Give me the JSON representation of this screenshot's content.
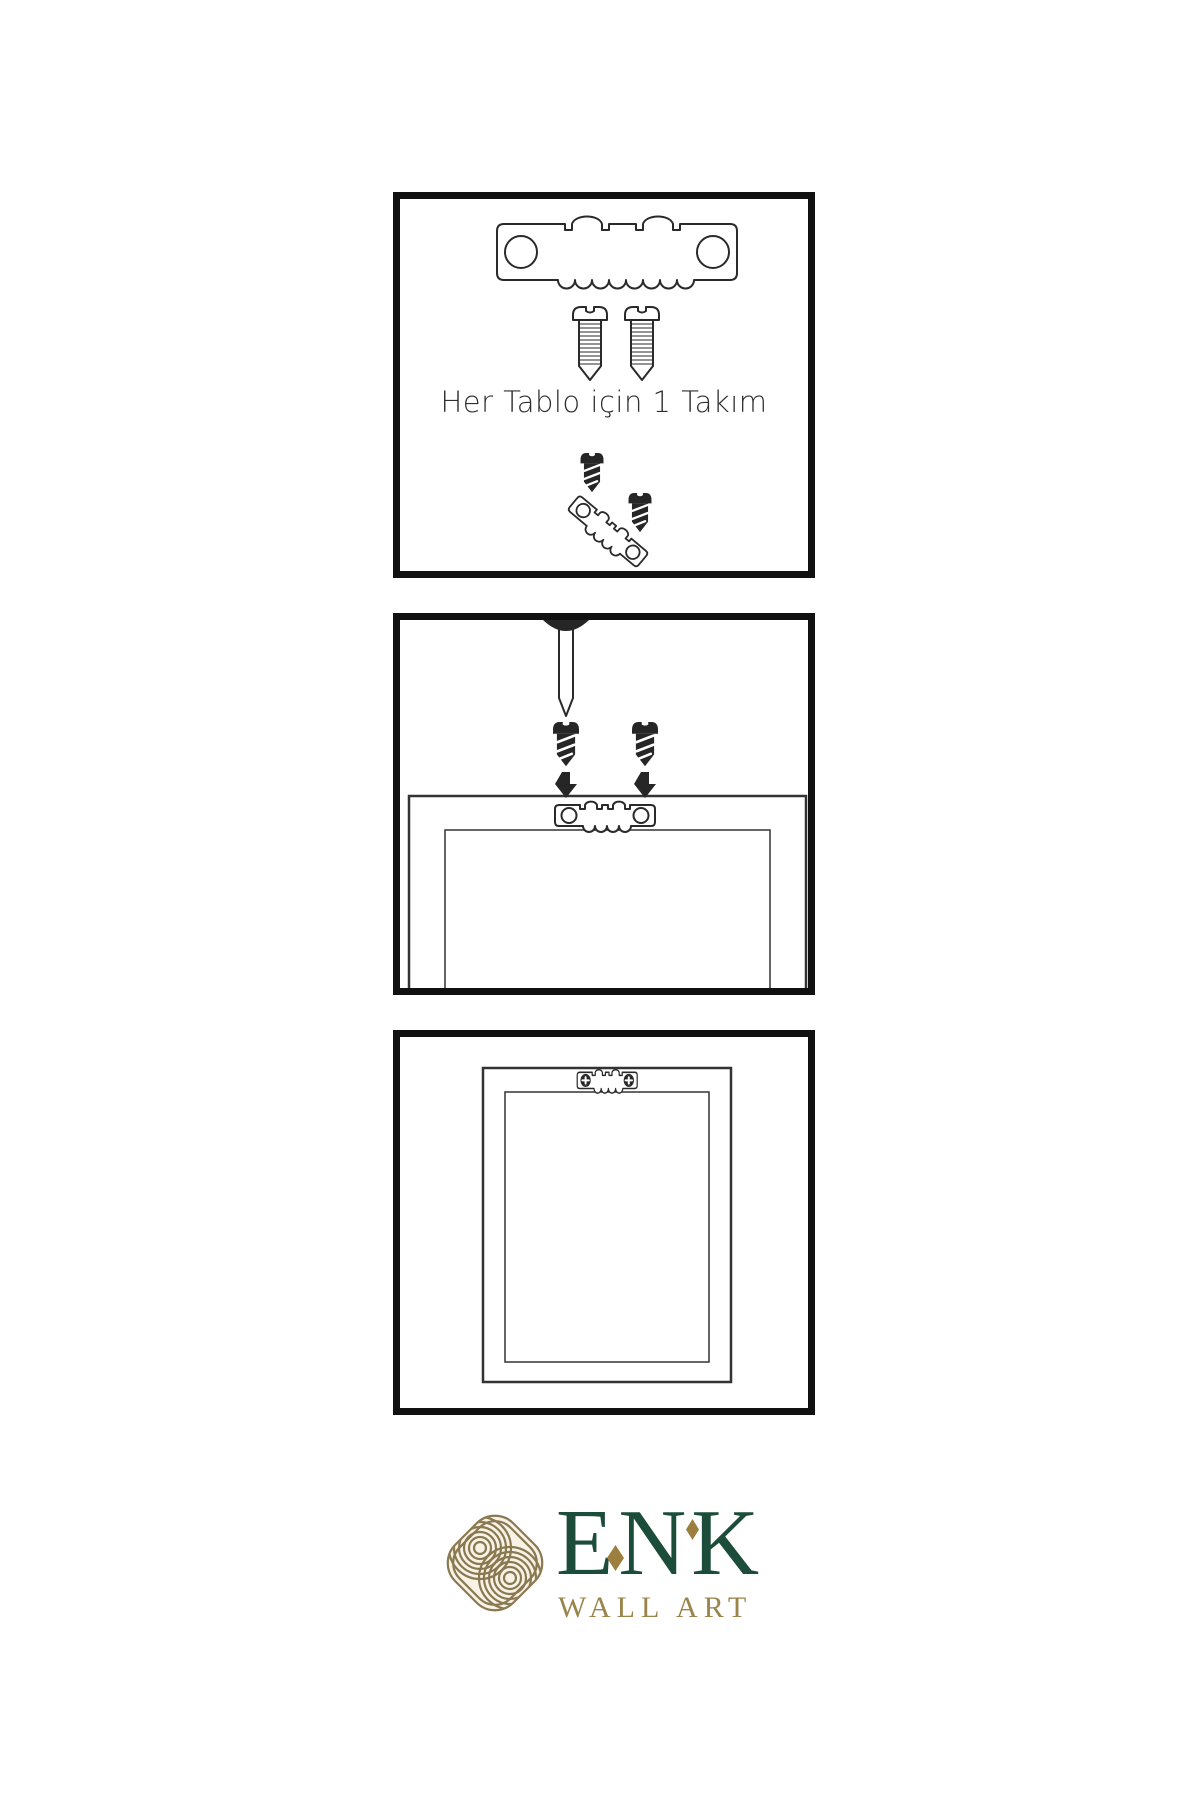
{
  "page": {
    "background": "#ffffff"
  },
  "panels": [
    {
      "id": "step-1-hardware-kit",
      "caption": "Her Tablo için 1 Takım",
      "parts": [
        "sawtooth-hanger-icon",
        "screw-icon",
        "screw-icon",
        "screw-dark-icon",
        "sawtooth-hanger-tilted-icon",
        "screw-dark-icon"
      ]
    },
    {
      "id": "step-2-attach-hanger",
      "caption": "",
      "parts": [
        "nail-icon",
        "screw-dark-icon",
        "screw-dark-icon",
        "arrow-down-icon",
        "arrow-down-icon",
        "frame-back-icon",
        "sawtooth-hanger-icon"
      ]
    },
    {
      "id": "step-3-hang-frame",
      "caption": "",
      "parts": [
        "frame-front-icon",
        "sawtooth-hanger-mounted-icon"
      ]
    }
  ],
  "logo": {
    "brand": "ENK",
    "subtitle": "WALL ART"
  },
  "colors": {
    "outline": "#2a2a2a",
    "panel_border": "#111111",
    "part_dark": "#262626",
    "frame_line": "#333333",
    "logo_green": "#1c4c3a",
    "logo_gold": "#9a8449",
    "emblem_gold": "#8a7950",
    "emblem_cream": "#f8f3e6",
    "diamond_gold": "#9c7f3e"
  }
}
